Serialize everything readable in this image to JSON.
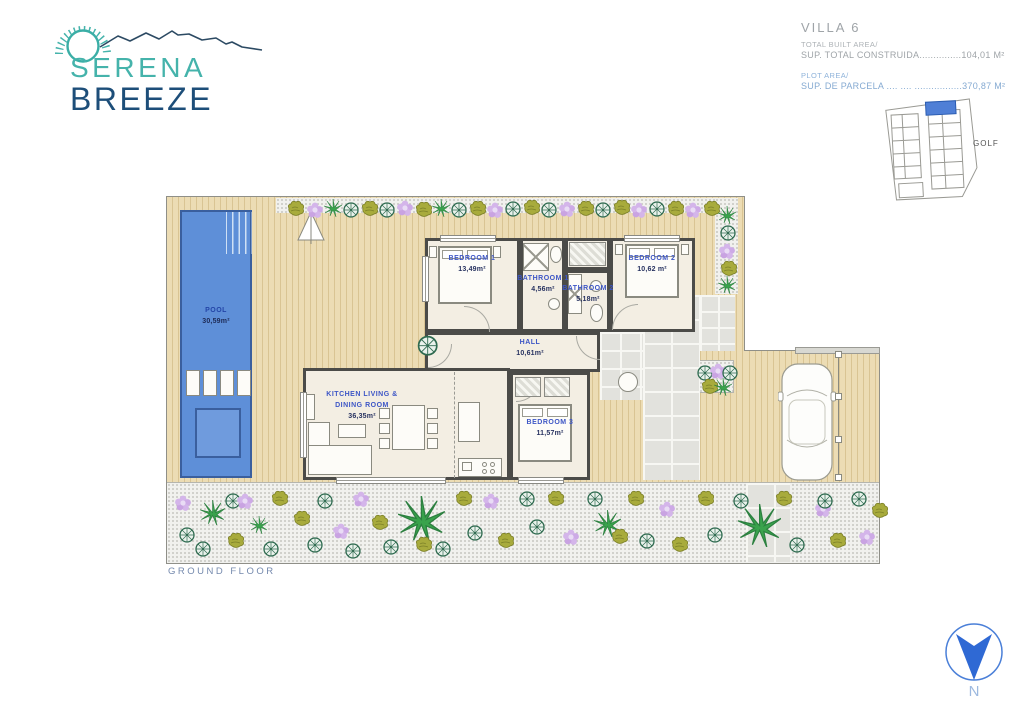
{
  "logo": {
    "line1": "SERENA",
    "line2": "BREEZE"
  },
  "header": {
    "villa_title": "VILLA 6",
    "built_area_label": "TOTAL BUILT AREA/",
    "built_area_line": "SUP. TOTAL CONSTRUIDA...............104,01 M²",
    "plot_area_label": "PLOT AREA/",
    "plot_area_line": "SUP. DE PARCELA .... .... .................370,87 M²"
  },
  "sitemap": {
    "golf_label": "GOLF",
    "highlight_color": "#4f7fd6"
  },
  "plan": {
    "rooms": {
      "pool": {
        "name": "POOL",
        "area": "30,59m²"
      },
      "bedroom1": {
        "name": "BEDROOM 1",
        "area": "13,49m²"
      },
      "bathroom1": {
        "name": "BATHROOM 1",
        "area": "4,56m²"
      },
      "bathroom2": {
        "name": "BATHROOM 2",
        "area": "5,18m²"
      },
      "bedroom2": {
        "name": "BEDROOM 2",
        "area": "10,62 m²"
      },
      "hall": {
        "name": "HALL",
        "area": "10,61m²"
      },
      "kitchen": {
        "name_line1": "KITCHEN LIVING &",
        "name_line2": "DINING ROOM",
        "area": "36,35m²"
      },
      "bedroom3": {
        "name": "BEDROOM 3",
        "area": "11,57m²"
      }
    }
  },
  "footer": {
    "floor_label": "GROUND FLOOR"
  },
  "compass": {
    "north_label": "N"
  },
  "colors": {
    "logo_teal": "#45b3ab",
    "logo_navy": "#1d4e79",
    "room_label_blue": "#3d56c6",
    "area_navy": "#273260",
    "pool_fill": "#5e8fd8",
    "pool_border": "#3a5f9e",
    "deck_tan": "#ecdcb4",
    "plot_area_text": "#85aad2",
    "built_area_text": "#9fa4a8",
    "ground_floor_text": "#7489ad",
    "compass_blue": "#2f69d4"
  },
  "decor": {
    "plants": [
      [
        120,
        4,
        "bush"
      ],
      [
        140,
        5,
        "flower"
      ],
      [
        158,
        3,
        "palm"
      ],
      [
        176,
        5,
        "shrub"
      ],
      [
        194,
        4,
        "bush"
      ],
      [
        212,
        5,
        "shrub"
      ],
      [
        230,
        3,
        "flower"
      ],
      [
        248,
        5,
        "bush"
      ],
      [
        266,
        3,
        "palm"
      ],
      [
        284,
        5,
        "shrub"
      ],
      [
        302,
        4,
        "bush"
      ],
      [
        320,
        5,
        "flower"
      ],
      [
        338,
        4,
        "shrub"
      ],
      [
        356,
        3,
        "bush"
      ],
      [
        374,
        5,
        "shrub"
      ],
      [
        392,
        4,
        "flower"
      ],
      [
        410,
        4,
        "bush"
      ],
      [
        428,
        5,
        "shrub"
      ],
      [
        446,
        3,
        "bush"
      ],
      [
        464,
        5,
        "flower"
      ],
      [
        482,
        4,
        "shrub"
      ],
      [
        500,
        4,
        "bush"
      ],
      [
        518,
        5,
        "flower"
      ],
      [
        536,
        4,
        "bush"
      ],
      [
        552,
        10,
        "palm"
      ],
      [
        553,
        28,
        "shrub"
      ],
      [
        552,
        46,
        "flower"
      ],
      [
        553,
        64,
        "bush"
      ],
      [
        552,
        80,
        "palm"
      ],
      [
        530,
        168,
        "shrub"
      ],
      [
        543,
        166,
        "flower"
      ],
      [
        555,
        168,
        "shrub"
      ],
      [
        534,
        182,
        "bush"
      ],
      [
        548,
        182,
        "palm"
      ],
      [
        250,
        138,
        "shrub",
        1.3
      ],
      [
        8,
        298,
        "flower"
      ],
      [
        12,
        330,
        "shrub"
      ],
      [
        28,
        344,
        "shrub"
      ],
      [
        34,
        304,
        "palm",
        1.4
      ],
      [
        58,
        296,
        "shrub"
      ],
      [
        60,
        336,
        "bush"
      ],
      [
        84,
        320,
        "palm"
      ],
      [
        96,
        344,
        "shrub"
      ],
      [
        104,
        294,
        "bush"
      ],
      [
        126,
        314,
        "bush"
      ],
      [
        140,
        340,
        "shrub"
      ],
      [
        150,
        296,
        "shrub"
      ],
      [
        166,
        326,
        "flower"
      ],
      [
        186,
        294,
        "flower"
      ],
      [
        178,
        346,
        "shrub"
      ],
      [
        204,
        318,
        "bush"
      ],
      [
        216,
        342,
        "shrub"
      ],
      [
        232,
        300,
        "palm",
        2.6
      ],
      [
        268,
        344,
        "shrub"
      ],
      [
        288,
        294,
        "bush"
      ],
      [
        300,
        328,
        "shrub"
      ],
      [
        316,
        296,
        "flower"
      ],
      [
        330,
        336,
        "bush"
      ],
      [
        352,
        294,
        "shrub"
      ],
      [
        362,
        322,
        "shrub"
      ],
      [
        380,
        294,
        "bush"
      ],
      [
        396,
        332,
        "flower"
      ],
      [
        420,
        294,
        "shrub"
      ],
      [
        428,
        314,
        "palm",
        1.5
      ],
      [
        460,
        294,
        "bush"
      ],
      [
        472,
        336,
        "shrub"
      ],
      [
        492,
        304,
        "flower"
      ],
      [
        504,
        340,
        "bush"
      ],
      [
        530,
        294,
        "bush"
      ],
      [
        540,
        330,
        "shrub"
      ],
      [
        566,
        296,
        "shrub"
      ],
      [
        572,
        308,
        "palm",
        2.4
      ],
      [
        608,
        294,
        "bush"
      ],
      [
        622,
        340,
        "shrub"
      ],
      [
        648,
        304,
        "flower"
      ],
      [
        662,
        336,
        "bush"
      ],
      [
        684,
        294,
        "shrub"
      ],
      [
        692,
        332,
        "flower"
      ],
      [
        704,
        306,
        "bush"
      ],
      [
        70,
        296,
        "flower"
      ],
      [
        248,
        340,
        "bush"
      ],
      [
        444,
        332,
        "bush"
      ],
      [
        650,
        296,
        "shrub"
      ]
    ]
  }
}
